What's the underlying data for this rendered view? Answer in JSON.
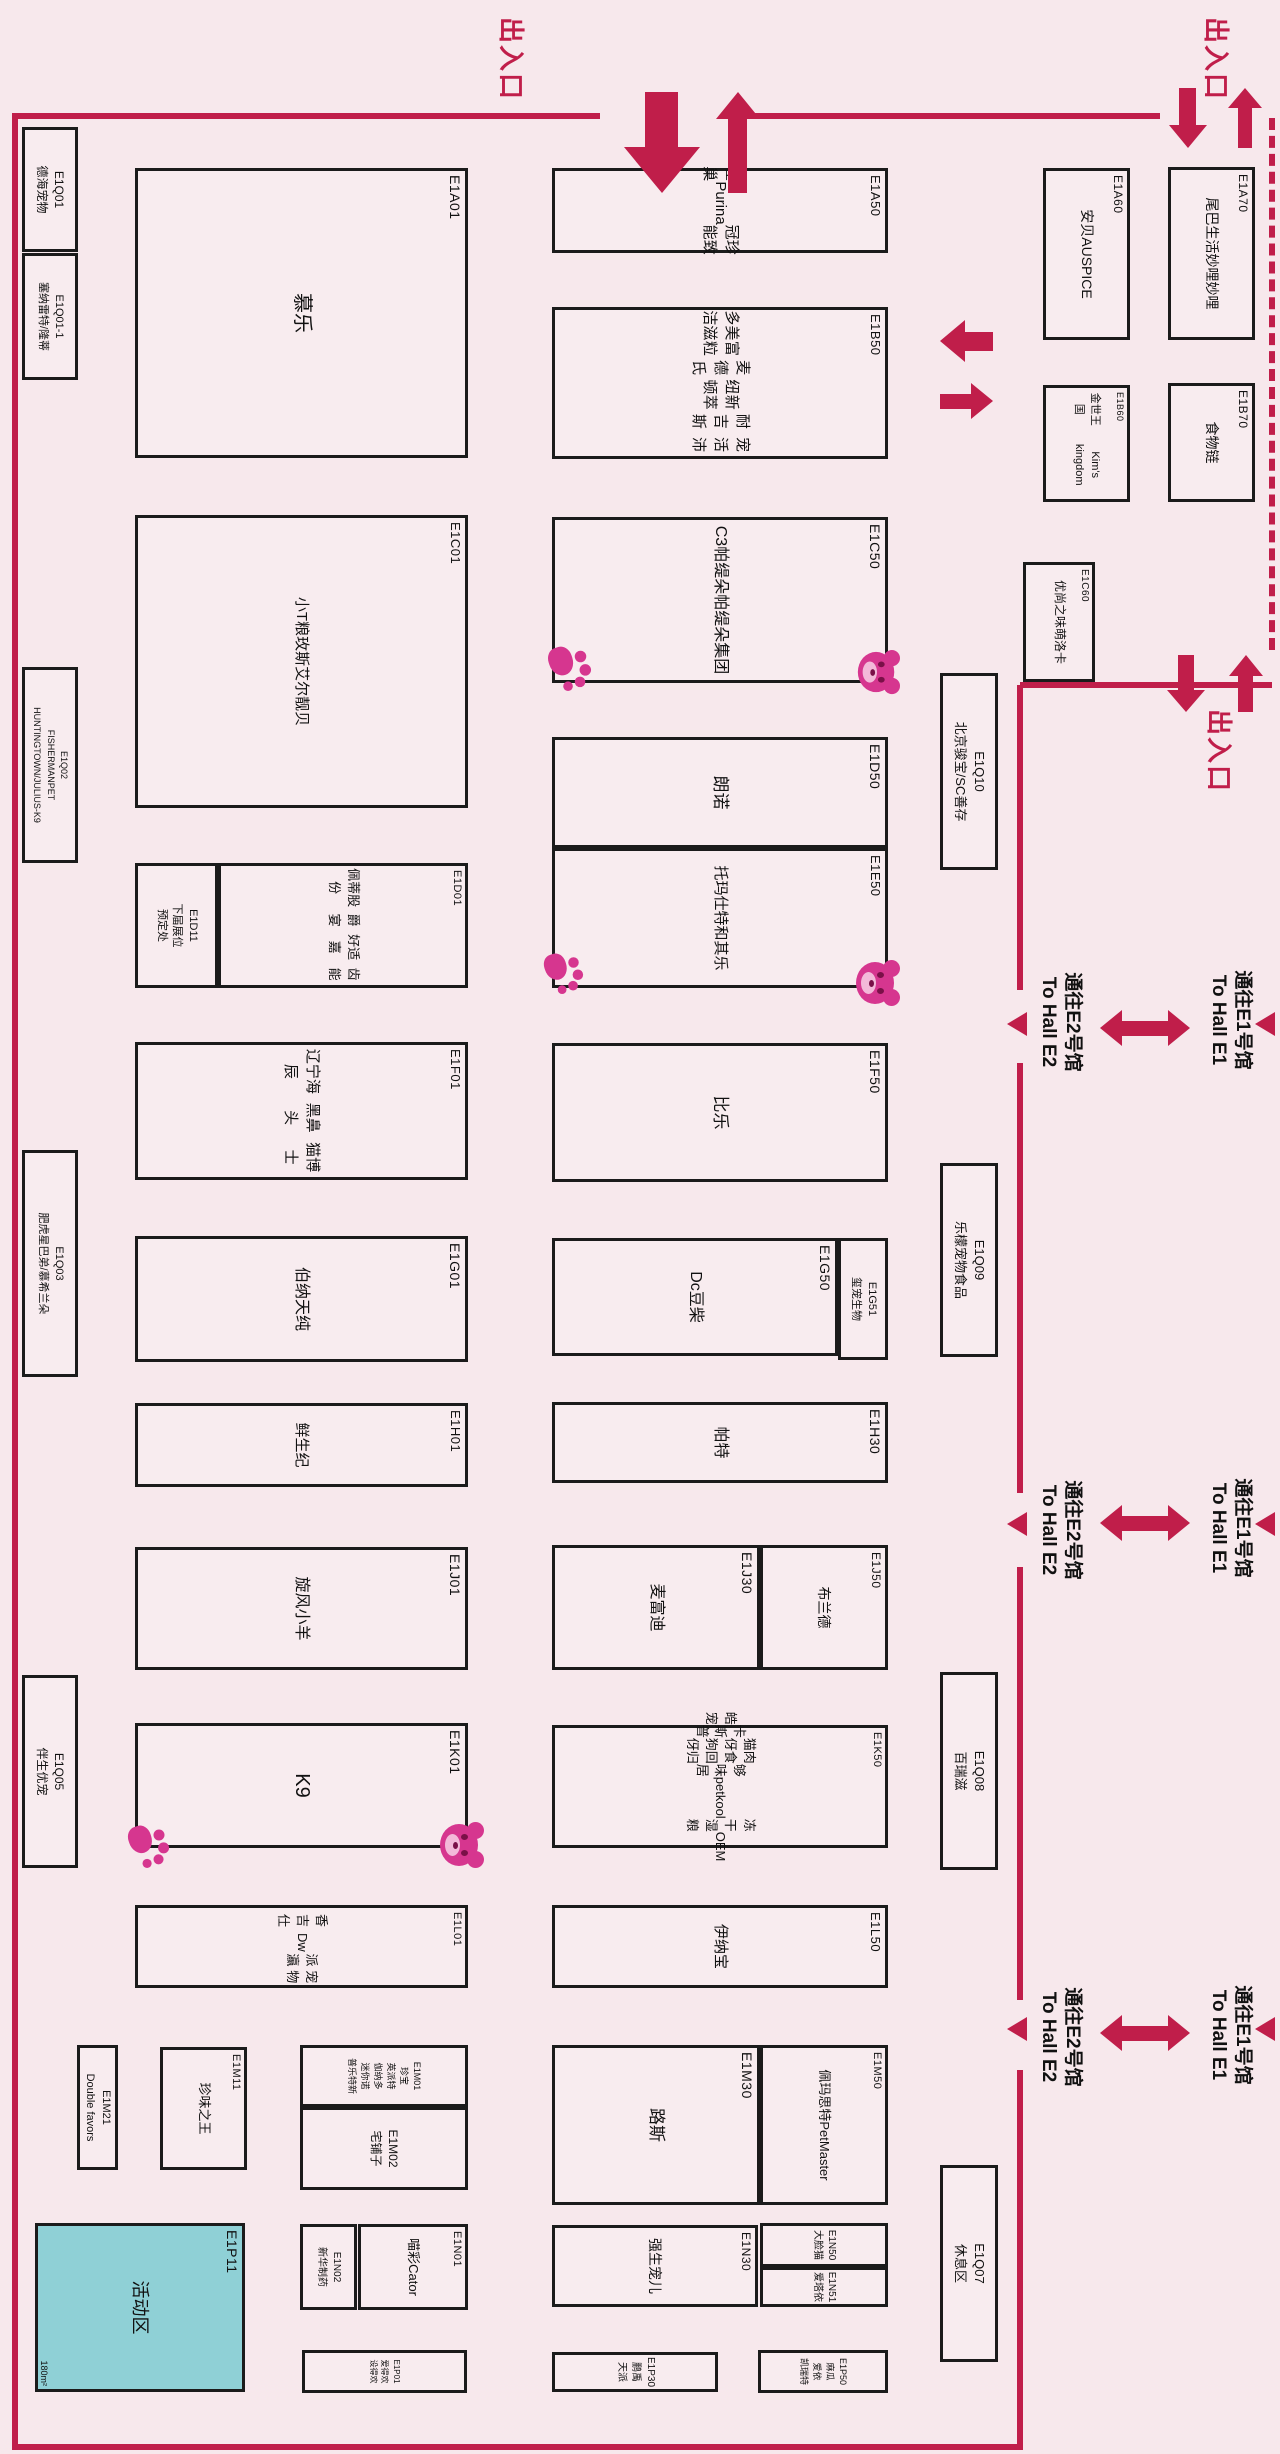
{
  "colors": {
    "background": "#f7e8ec",
    "booth_fill": "#f8ecef",
    "outline": "#1b1b1b",
    "accent_red": "#c01e4a",
    "activity_teal": "#8fd0d6",
    "icon_pink": "#d6368f"
  },
  "entrance_label": "出入口",
  "hall_links": {
    "to_e1": [
      "通往E1号馆",
      "To Hall E1"
    ],
    "to_e2": [
      "通往E2号馆",
      "To Hall E2"
    ]
  },
  "walls": [
    {
      "x": 113,
      "y": 120,
      "w": 6,
      "h": 405
    },
    {
      "x": 113,
      "y": 680,
      "w": 6,
      "h": 588
    },
    {
      "x": 113,
      "y": 1262,
      "w": 2337,
      "h": 6
    },
    {
      "x": 2444,
      "y": 260,
      "w": 6,
      "h": 1008
    },
    {
      "x": 685,
      "y": 257,
      "w": 305,
      "h": 6
    },
    {
      "x": 1063,
      "y": 257,
      "w": 430,
      "h": 6
    },
    {
      "x": 1567,
      "y": 257,
      "w": 433,
      "h": 6
    },
    {
      "x": 2070,
      "y": 257,
      "w": 380,
      "h": 6
    },
    {
      "x": 682,
      "y": 8,
      "w": 6,
      "h": 252
    },
    {
      "x": 118,
      "y": 5,
      "w": 532,
      "h": 0,
      "dashed": true
    }
  ],
  "booths": [
    {
      "id": "E1A70",
      "label": "E1A70",
      "lines": [
        "尾巴生活",
        "妙哩妙哩"
      ],
      "x": 167,
      "y": 25,
      "w": 173,
      "h": 87,
      "v": "corner",
      "fs": 14
    },
    {
      "id": "E1B70",
      "label": "E1B70",
      "lines": [
        "食物链"
      ],
      "x": 383,
      "y": 25,
      "w": 119,
      "h": 87,
      "v": "corner",
      "fs": 14
    },
    {
      "id": "E1A60",
      "label": "E1A60",
      "lines": [
        "安贝",
        "AUSPICE"
      ],
      "x": 168,
      "y": 150,
      "w": 172,
      "h": 87,
      "v": "corner",
      "fs": 14
    },
    {
      "id": "E1B60",
      "label": "E1B60",
      "lines": [
        "金世王国",
        "Kim's kingdom"
      ],
      "x": 385,
      "y": 150,
      "w": 117,
      "h": 87,
      "v": "corner",
      "fs": 11
    },
    {
      "id": "E1C60",
      "label": "E1C60",
      "lines": [
        "优尚之味",
        "萌洛卡"
      ],
      "x": 562,
      "y": 185,
      "w": 120,
      "h": 72,
      "v": "corner",
      "fs": 12
    },
    {
      "id": "E1Q10",
      "label": "E1Q10",
      "lines": [
        "北京骏宝/SC善存"
      ],
      "x": 673,
      "y": 282,
      "w": 197,
      "h": 58,
      "v": "stack",
      "fs": 13
    },
    {
      "id": "E1Q09",
      "label": "E1Q09",
      "lines": [
        "乐檬宠物食品"
      ],
      "x": 1163,
      "y": 282,
      "w": 194,
      "h": 58,
      "v": "stack",
      "fs": 13
    },
    {
      "id": "E1Q08",
      "label": "E1Q08",
      "lines": [
        "百瑞滋"
      ],
      "x": 1672,
      "y": 282,
      "w": 198,
      "h": 58,
      "v": "stack",
      "fs": 13
    },
    {
      "id": "E1Q07",
      "label": "E1Q07",
      "lines": [
        "休息区"
      ],
      "x": 2165,
      "y": 282,
      "w": 197,
      "h": 58,
      "v": "stack",
      "fs": 13
    },
    {
      "id": "E1A50",
      "label": "E1A50",
      "lines": [
        "雀巢",
        "Purina",
        "冠能",
        "珍致"
      ],
      "x": 168,
      "y": 392,
      "w": 85,
      "h": 336,
      "v": "corner",
      "fs": 15
    },
    {
      "id": "E1B50",
      "label": "E1B50",
      "lines": [
        "多美洁滋",
        "富粒",
        "麦德氏",
        "纽顿",
        "新萃",
        "耐吉斯",
        "宠活沛"
      ],
      "x": 307,
      "y": 392,
      "w": 152,
      "h": 336,
      "v": "corner",
      "fs": 15
    },
    {
      "id": "E1C50",
      "label": "E1C50",
      "lines": [
        "C3帕缇朵",
        "帕缇朵集团"
      ],
      "x": 517,
      "y": 392,
      "w": 166,
      "h": 336,
      "v": "corner",
      "fs": 16
    },
    {
      "id": "E1D50",
      "label": "E1D50",
      "lines": [
        "朗诺"
      ],
      "x": 737,
      "y": 392,
      "w": 111,
      "h": 336,
      "v": "corner",
      "fs": 17
    },
    {
      "id": "E1E50",
      "label": "E1E50",
      "lines": [
        "托玛仕特",
        "和其乐"
      ],
      "x": 848,
      "y": 392,
      "w": 140,
      "h": 336,
      "v": "corner",
      "fs": 15
    },
    {
      "id": "E1F50",
      "label": "E1F50",
      "lines": [
        "比乐"
      ],
      "x": 1043,
      "y": 392,
      "w": 139,
      "h": 336,
      "v": "corner",
      "fs": 17
    },
    {
      "id": "E1G51",
      "label": "E1G51",
      "lines": [
        "玺宠生物"
      ],
      "x": 1238,
      "y": 392,
      "w": 122,
      "h": 50,
      "v": "stack",
      "fs": 11
    },
    {
      "id": "E1G50",
      "label": "E1G50",
      "lines": [
        "Dc豆柴"
      ],
      "x": 1238,
      "y": 442,
      "w": 118,
      "h": 286,
      "v": "corner",
      "fs": 16
    },
    {
      "id": "E1H30",
      "label": "E1H30",
      "lines": [
        "帕特"
      ],
      "x": 1402,
      "y": 392,
      "w": 81,
      "h": 336,
      "v": "corner",
      "fs": 16
    },
    {
      "id": "E1J50",
      "label": "E1J50",
      "lines": [
        "布兰德"
      ],
      "x": 1545,
      "y": 392,
      "w": 125,
      "h": 128,
      "v": "corner",
      "fs": 14
    },
    {
      "id": "E1J30",
      "label": "E1J30",
      "lines": [
        "麦富迪"
      ],
      "x": 1545,
      "y": 520,
      "w": 125,
      "h": 208,
      "v": "corner",
      "fs": 16
    },
    {
      "id": "E1K50",
      "label": "E1K50",
      "lines": [
        "皓宠",
        "卡斯普",
        "猫伢狗伢",
        "肉食回归",
        "够味居",
        "petkool",
        "冻干湿粮",
        "OEM"
      ],
      "x": 1725,
      "y": 392,
      "w": 123,
      "h": 336,
      "v": "corner",
      "fs": 13
    },
    {
      "id": "E1L50",
      "label": "E1L50",
      "lines": [
        "伊纳",
        "宝"
      ],
      "x": 1905,
      "y": 392,
      "w": 83,
      "h": 336,
      "v": "corner",
      "fs": 15
    },
    {
      "id": "E1M50",
      "label": "E1M50",
      "lines": [
        "佩玛思特",
        "PetMaster"
      ],
      "x": 2045,
      "y": 392,
      "w": 160,
      "h": 128,
      "v": "corner",
      "fs": 13
    },
    {
      "id": "E1M30",
      "label": "E1M30",
      "lines": [
        "路斯"
      ],
      "x": 2045,
      "y": 520,
      "w": 160,
      "h": 208,
      "v": "corner",
      "fs": 17
    },
    {
      "id": "E1N50",
      "label": "E1N50",
      "lines": [
        "大脸猫"
      ],
      "x": 2223,
      "y": 392,
      "w": 44,
      "h": 128,
      "v": "stack",
      "fs": 10
    },
    {
      "id": "E1N51",
      "label": "E1N51",
      "lines": [
        "爱塔依"
      ],
      "x": 2267,
      "y": 392,
      "w": 40,
      "h": 128,
      "v": "stack",
      "fs": 10
    },
    {
      "id": "E1N30",
      "label": "E1N30",
      "lines": [
        "强生",
        "宠儿"
      ],
      "x": 2225,
      "y": 522,
      "w": 82,
      "h": 206,
      "v": "corner",
      "fs": 14
    },
    {
      "id": "E1P50",
      "label": "E1P50",
      "lines": [
        "麻瓜",
        "爱依",
        "凯瑞特"
      ],
      "x": 2350,
      "y": 392,
      "w": 43,
      "h": 130,
      "v": "stack",
      "fs": 9
    },
    {
      "id": "E1P30",
      "label": "E1P30",
      "lines": [
        "鹏禹",
        "天派"
      ],
      "x": 2352,
      "y": 562,
      "w": 40,
      "h": 166,
      "v": "stack",
      "fs": 10
    },
    {
      "id": "E1A01",
      "label": "E1A01",
      "lines": [
        "慕乐"
      ],
      "x": 168,
      "y": 812,
      "w": 290,
      "h": 333,
      "v": "corner",
      "fs": 20
    },
    {
      "id": "E1C01",
      "label": "E1C01",
      "lines": [
        "小T粮",
        "玫斯",
        "艾尔",
        "靓贝"
      ],
      "x": 515,
      "y": 812,
      "w": 293,
      "h": 333,
      "v": "corner",
      "fs": 15
    },
    {
      "id": "E1D01",
      "label": "E1D01",
      "lines": [
        "佩蒂股份",
        "爵宴",
        "好适嘉",
        "齿能"
      ],
      "x": 863,
      "y": 812,
      "w": 125,
      "h": 250,
      "v": "corner",
      "fs": 13
    },
    {
      "id": "E1D11",
      "label": "E1D11",
      "lines": [
        "下届展位",
        "预定处"
      ],
      "x": 863,
      "y": 1062,
      "w": 125,
      "h": 83,
      "v": "stack",
      "fs": 11
    },
    {
      "id": "E1F01",
      "label": "E1F01",
      "lines": [
        "辽宁海辰",
        "黑鼻头",
        "猫博士"
      ],
      "x": 1042,
      "y": 812,
      "w": 138,
      "h": 333,
      "v": "corner",
      "fs": 15
    },
    {
      "id": "E1G01",
      "label": "E1G01",
      "lines": [
        "伯纳",
        "天纯"
      ],
      "x": 1236,
      "y": 812,
      "w": 126,
      "h": 333,
      "v": "corner",
      "fs": 16
    },
    {
      "id": "E1H01",
      "label": "E1H01",
      "lines": [
        "鲜生",
        "纪"
      ],
      "x": 1403,
      "y": 812,
      "w": 84,
      "h": 333,
      "v": "corner",
      "fs": 15
    },
    {
      "id": "E1J01",
      "label": "E1J01",
      "lines": [
        "旋风",
        "小羊"
      ],
      "x": 1547,
      "y": 812,
      "w": 123,
      "h": 333,
      "v": "corner",
      "fs": 16
    },
    {
      "id": "E1K01",
      "label": "E1K01",
      "lines": [
        "K9"
      ],
      "x": 1723,
      "y": 812,
      "w": 125,
      "h": 333,
      "v": "corner",
      "fs": 20
    },
    {
      "id": "E1L01",
      "label": "E1L01",
      "lines": [
        "香吉仕",
        "Dw",
        "派瀛",
        "宠物"
      ],
      "x": 1905,
      "y": 812,
      "w": 83,
      "h": 333,
      "v": "corner",
      "fs": 13
    },
    {
      "id": "E1M01",
      "label": "E1M01",
      "lines": [
        "珍宝",
        "英派特",
        "伽纳多",
        "迷你诺",
        "普乐特新"
      ],
      "x": 2045,
      "y": 812,
      "w": 62,
      "h": 168,
      "v": "stack",
      "fs": 9
    },
    {
      "id": "E1M02",
      "label": "E1M02",
      "lines": [
        "宅铺子"
      ],
      "x": 2107,
      "y": 812,
      "w": 83,
      "h": 168,
      "v": "stack",
      "fs": 12
    },
    {
      "id": "E1M11",
      "label": "E1M11",
      "lines": [
        "珍味",
        "之王"
      ],
      "x": 2047,
      "y": 1033,
      "w": 123,
      "h": 87,
      "v": "corner",
      "fs": 13
    },
    {
      "id": "E1M21",
      "label": "E1M21",
      "lines": [
        "Double favors"
      ],
      "x": 2045,
      "y": 1162,
      "w": 125,
      "h": 41,
      "v": "stack",
      "fs": 11
    },
    {
      "id": "E1N01",
      "label": "E1N01",
      "lines": [
        "喵彩",
        "Cator"
      ],
      "x": 2224,
      "y": 812,
      "w": 86,
      "h": 110,
      "v": "corner",
      "fs": 13
    },
    {
      "id": "E1N02",
      "label": "E1N02",
      "lines": [
        "新华制药"
      ],
      "x": 2224,
      "y": 923,
      "w": 86,
      "h": 57,
      "v": "stack",
      "fs": 10
    },
    {
      "id": "E1P01",
      "label": "E1P01",
      "lines": [
        "爱得欢",
        "设得欢"
      ],
      "x": 2350,
      "y": 813,
      "w": 43,
      "h": 165,
      "v": "stack",
      "fs": 8
    },
    {
      "id": "E1P11",
      "label": "E1P11",
      "lines": [
        "活动区"
      ],
      "x": 2223,
      "y": 1035,
      "w": 169,
      "h": 210,
      "v": "corner",
      "fs": 18,
      "fill": "teal",
      "note": "180m²"
    },
    {
      "id": "E1Q01",
      "label": "E1Q01",
      "lines": [
        "德海宠物"
      ],
      "x": 127,
      "y": 1202,
      "w": 125,
      "h": 56,
      "v": "stack",
      "fs": 12
    },
    {
      "id": "E1Q01-1",
      "label": "E1Q01-1",
      "lines": [
        "塞纳雷特/隆蒂"
      ],
      "x": 253,
      "y": 1202,
      "w": 127,
      "h": 56,
      "v": "stack",
      "fs": 11
    },
    {
      "id": "E1Q02",
      "label": "E1Q02",
      "lines": [
        "FISHERMANPET",
        "HUNTINGTOWN/JULIUS-K9"
      ],
      "x": 667,
      "y": 1202,
      "w": 196,
      "h": 56,
      "v": "stack",
      "fs": 9
    },
    {
      "id": "E1Q03",
      "label": "E1Q03",
      "lines": [
        "肥虎星巴弟/慕希兰朵"
      ],
      "x": 1150,
      "y": 1202,
      "w": 227,
      "h": 56,
      "v": "stack",
      "fs": 11
    },
    {
      "id": "E1Q05",
      "label": "E1Q05",
      "lines": [
        "伴生优宠"
      ],
      "x": 1675,
      "y": 1202,
      "w": 193,
      "h": 56,
      "v": "stack",
      "fs": 12
    }
  ],
  "arrows": [
    {
      "dir": "right",
      "x": 92,
      "y": 580,
      "len": 101,
      "b": 77
    },
    {
      "dir": "left",
      "x": 92,
      "y": 520,
      "len": 101,
      "b": 45
    },
    {
      "dir": "right",
      "x": 88,
      "y": 73,
      "len": 60,
      "b": 39
    },
    {
      "dir": "left",
      "x": 88,
      "y": 18,
      "len": 60,
      "b": 34
    },
    {
      "dir": "right",
      "x": 655,
      "y": 75,
      "len": 57,
      "b": 38
    },
    {
      "dir": "left",
      "x": 655,
      "y": 17,
      "len": 57,
      "b": 35
    },
    {
      "dir": "down",
      "x": 320,
      "y": 287,
      "len": 53,
      "b": 43
    },
    {
      "dir": "up",
      "x": 383,
      "y": 287,
      "len": 53,
      "b": 37
    },
    {
      "dir": "vboth",
      "x": 1010,
      "y": 90,
      "len": 90,
      "b": 37
    },
    {
      "dir": "vboth",
      "x": 1505,
      "y": 90,
      "len": 90,
      "b": 37
    },
    {
      "dir": "vboth",
      "x": 2015,
      "y": 90,
      "len": 90,
      "b": 37
    }
  ],
  "triangles": [
    {
      "x": 1012,
      "y": 5
    },
    {
      "x": 1012,
      "y": 253
    },
    {
      "x": 1512,
      "y": 5
    },
    {
      "x": 1512,
      "y": 253
    },
    {
      "x": 2017,
      "y": 5
    },
    {
      "x": 2017,
      "y": 253
    }
  ],
  "signs": [
    {
      "x": 955,
      "y": 26,
      "w": 130,
      "kind": "hall",
      "lines": [
        "通往E1号馆",
        "To Hall E1"
      ],
      "fs": 19
    },
    {
      "x": 958,
      "y": 196,
      "w": 128,
      "kind": "hall",
      "lines": [
        "通往E2号馆",
        "To Hall E2"
      ],
      "fs": 19
    },
    {
      "x": 1463,
      "y": 26,
      "w": 130,
      "kind": "hall",
      "lines": [
        "通往E1号馆",
        "To Hall E1"
      ],
      "fs": 19
    },
    {
      "x": 1466,
      "y": 196,
      "w": 128,
      "kind": "hall",
      "lines": [
        "通往E2号馆",
        "To Hall E2"
      ],
      "fs": 19
    },
    {
      "x": 1970,
      "y": 26,
      "w": 130,
      "kind": "hall",
      "lines": [
        "通往E1号馆",
        "To Hall E1"
      ],
      "fs": 19
    },
    {
      "x": 1973,
      "y": 196,
      "w": 128,
      "kind": "hall",
      "lines": [
        "通往E2号馆",
        "To Hall E2"
      ],
      "fs": 19
    },
    {
      "x": 14,
      "y": 753,
      "w": 90,
      "kind": "entry",
      "lines": [
        "出入口"
      ]
    },
    {
      "x": 14,
      "y": 48,
      "w": 90,
      "kind": "entry",
      "lines": [
        "出入口"
      ]
    },
    {
      "x": 706,
      "y": 45,
      "w": 90,
      "kind": "entry",
      "lines": [
        "出入口"
      ]
    }
  ],
  "icons": [
    {
      "t": "paw",
      "x": 645,
      "y": 688,
      "s": 46
    },
    {
      "t": "bear",
      "x": 650,
      "y": 380,
      "s": 46
    },
    {
      "t": "paw",
      "x": 952,
      "y": 696,
      "s": 42
    },
    {
      "t": "bear",
      "x": 960,
      "y": 380,
      "s": 48
    },
    {
      "t": "paw",
      "x": 1824,
      "y": 1110,
      "s": 44
    },
    {
      "t": "bear",
      "x": 1822,
      "y": 796,
      "s": 48
    }
  ]
}
